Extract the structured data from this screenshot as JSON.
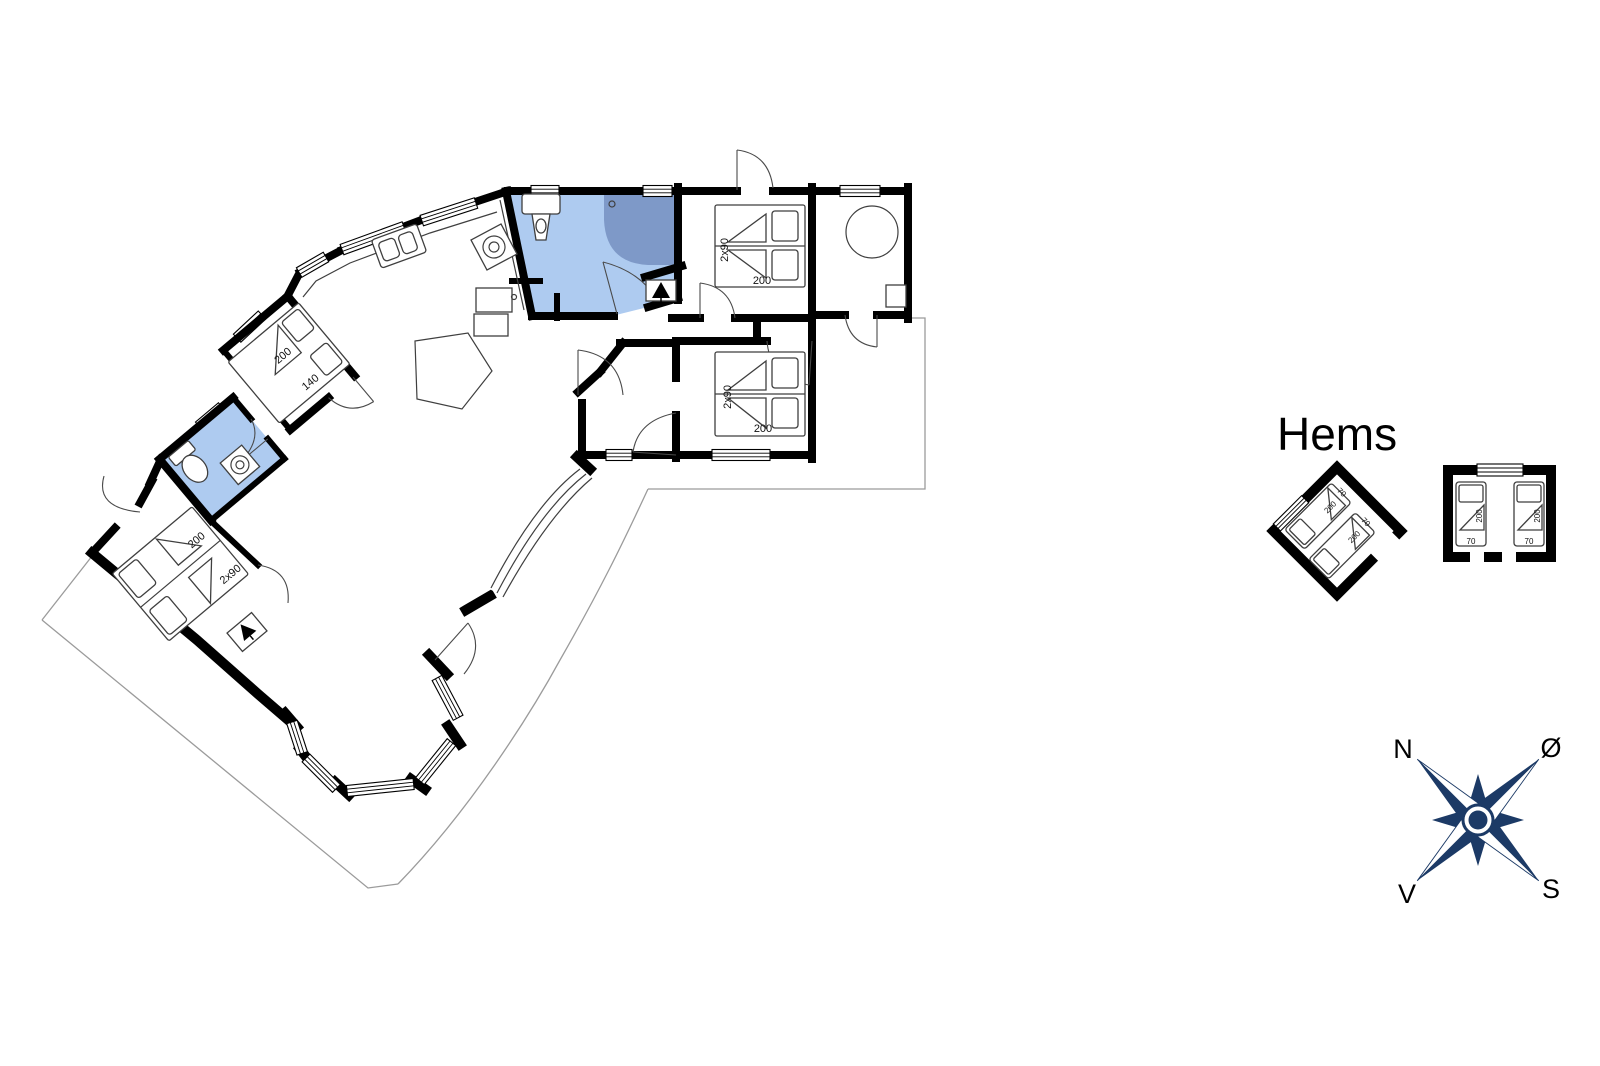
{
  "floorplan": {
    "colors": {
      "wall": "#000000",
      "bathroom_fill": "#aecbf0",
      "shower_fill": "#7e99c8",
      "furniture_stroke": "#3f3f3f",
      "terrace_stroke": "#9b9b9b",
      "compass_navy": "#1c3a66"
    },
    "rooms": {
      "bedroom_top_right": {
        "bed_width": "2x90",
        "bed_length": "200"
      },
      "bedroom_mid_right": {
        "bed_width": "2x90",
        "bed_length": "200"
      },
      "bedroom_mid_left": {
        "bed_length": "200",
        "bed_width": "140"
      },
      "bedroom_bottom_left": {
        "bed_length": "200",
        "bed_width": "2x90"
      }
    },
    "hems": {
      "title": "Hems",
      "rotated_room": {
        "bed1_length": "200",
        "bed1_width": "70",
        "bed2_length": "200",
        "bed2_width": "70"
      },
      "square_room": {
        "bed1_length": "200",
        "bed1_width": "70",
        "bed2_length": "200",
        "bed2_width": "70"
      }
    },
    "compass": {
      "north": "N",
      "east": "Ø",
      "west": "V",
      "south": "S"
    }
  }
}
